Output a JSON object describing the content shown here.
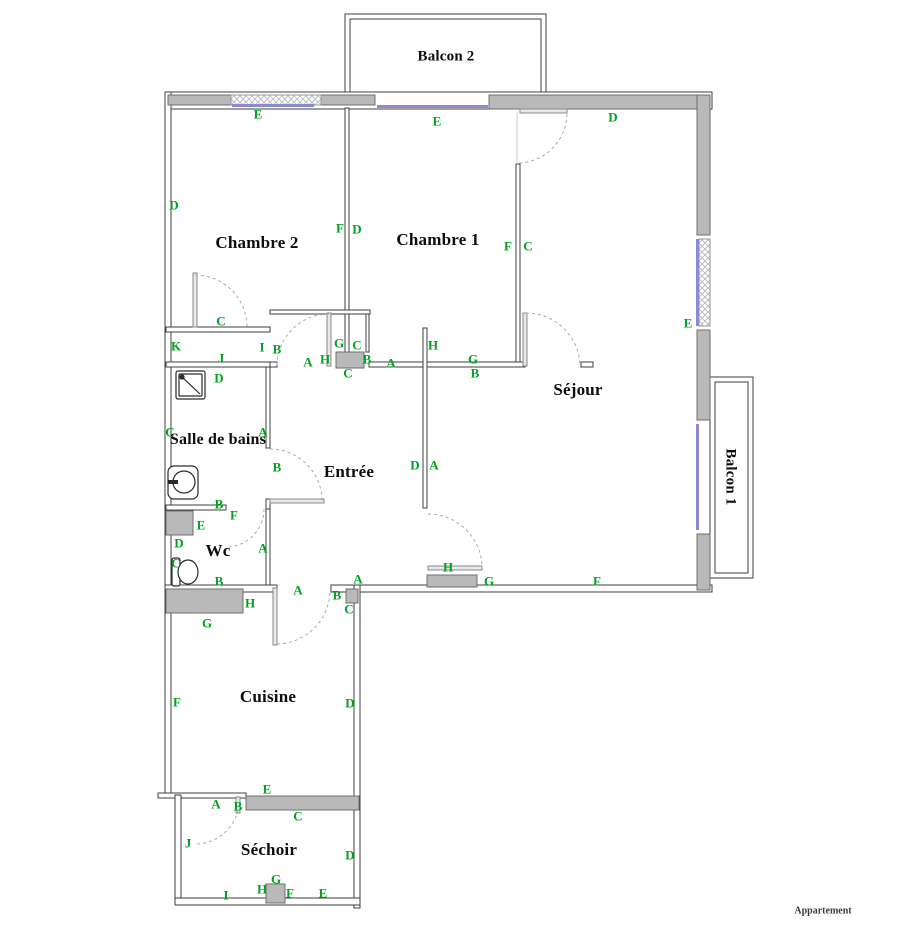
{
  "watermark": "Appartement",
  "colors": {
    "marker_green": "#00a21f",
    "wall_gray": "#b9b9b9",
    "window_blue": "#8a8ad0"
  },
  "rooms": [
    {
      "label": "Balcon 2",
      "x": 446,
      "y": 57,
      "size": 15
    },
    {
      "label": "Chambre 2",
      "x": 257,
      "y": 243,
      "size": 17
    },
    {
      "label": "Chambre 1",
      "x": 438,
      "y": 240,
      "size": 17
    },
    {
      "label": "Séjour",
      "x": 578,
      "y": 390,
      "size": 17
    },
    {
      "label": "Balcon 1",
      "x": 730,
      "y": 477,
      "size": 15,
      "rotate": 90
    },
    {
      "label": "Salle de bains",
      "x": 218,
      "y": 440,
      "size": 16
    },
    {
      "label": "Entrée",
      "x": 349,
      "y": 472,
      "size": 17
    },
    {
      "label": "Wc",
      "x": 218,
      "y": 551,
      "size": 17
    },
    {
      "label": "Cuisine",
      "x": 268,
      "y": 697,
      "size": 17
    },
    {
      "label": "Séchoir",
      "x": 269,
      "y": 850,
      "size": 17
    }
  ],
  "markers": [
    {
      "label": "E",
      "x": 258,
      "y": 114
    },
    {
      "label": "E",
      "x": 437,
      "y": 121
    },
    {
      "label": "D",
      "x": 613,
      "y": 117
    },
    {
      "label": "D",
      "x": 174,
      "y": 205
    },
    {
      "label": "F",
      "x": 340,
      "y": 228
    },
    {
      "label": "D",
      "x": 357,
      "y": 229
    },
    {
      "label": "F",
      "x": 508,
      "y": 246
    },
    {
      "label": "C",
      "x": 528,
      "y": 246
    },
    {
      "label": "C",
      "x": 221,
      "y": 321
    },
    {
      "label": "K",
      "x": 176,
      "y": 346
    },
    {
      "label": "I",
      "x": 262,
      "y": 347
    },
    {
      "label": "J",
      "x": 221,
      "y": 358
    },
    {
      "label": "D",
      "x": 219,
      "y": 378
    },
    {
      "label": "B",
      "x": 277,
      "y": 349
    },
    {
      "label": "A",
      "x": 308,
      "y": 362
    },
    {
      "label": "H",
      "x": 325,
      "y": 359
    },
    {
      "label": "G",
      "x": 339,
      "y": 343
    },
    {
      "label": "C",
      "x": 357,
      "y": 345
    },
    {
      "label": "B",
      "x": 367,
      "y": 359
    },
    {
      "label": "C",
      "x": 348,
      "y": 373
    },
    {
      "label": "A",
      "x": 391,
      "y": 363
    },
    {
      "label": "H",
      "x": 433,
      "y": 345
    },
    {
      "label": "G",
      "x": 473,
      "y": 359
    },
    {
      "label": "B",
      "x": 475,
      "y": 373
    },
    {
      "label": "E",
      "x": 688,
      "y": 323
    },
    {
      "label": "C",
      "x": 170,
      "y": 432
    },
    {
      "label": "A",
      "x": 263,
      "y": 432
    },
    {
      "label": "B",
      "x": 277,
      "y": 467
    },
    {
      "label": "D",
      "x": 415,
      "y": 465
    },
    {
      "label": "A",
      "x": 434,
      "y": 465
    },
    {
      "label": "B",
      "x": 219,
      "y": 504
    },
    {
      "label": "F",
      "x": 234,
      "y": 515
    },
    {
      "label": "E",
      "x": 201,
      "y": 525
    },
    {
      "label": "D",
      "x": 179,
      "y": 543
    },
    {
      "label": "A",
      "x": 263,
      "y": 548
    },
    {
      "label": "C",
      "x": 176,
      "y": 563
    },
    {
      "label": "B",
      "x": 219,
      "y": 581
    },
    {
      "label": "A",
      "x": 358,
      "y": 579
    },
    {
      "label": "H",
      "x": 448,
      "y": 567
    },
    {
      "label": "G",
      "x": 489,
      "y": 581
    },
    {
      "label": "F",
      "x": 597,
      "y": 581
    },
    {
      "label": "A",
      "x": 298,
      "y": 590
    },
    {
      "label": "B",
      "x": 337,
      "y": 595
    },
    {
      "label": "C",
      "x": 349,
      "y": 609
    },
    {
      "label": "H",
      "x": 250,
      "y": 603
    },
    {
      "label": "G",
      "x": 207,
      "y": 623
    },
    {
      "label": "F",
      "x": 177,
      "y": 702
    },
    {
      "label": "D",
      "x": 350,
      "y": 703
    },
    {
      "label": "E",
      "x": 267,
      "y": 789
    },
    {
      "label": "A",
      "x": 216,
      "y": 804
    },
    {
      "label": "B",
      "x": 238,
      "y": 806
    },
    {
      "label": "C",
      "x": 298,
      "y": 816
    },
    {
      "label": "J",
      "x": 188,
      "y": 843
    },
    {
      "label": "D",
      "x": 350,
      "y": 855
    },
    {
      "label": "G",
      "x": 276,
      "y": 879
    },
    {
      "label": "H",
      "x": 262,
      "y": 889
    },
    {
      "label": "F",
      "x": 290,
      "y": 893
    },
    {
      "label": "E",
      "x": 323,
      "y": 893
    },
    {
      "label": "I",
      "x": 226,
      "y": 895
    }
  ]
}
